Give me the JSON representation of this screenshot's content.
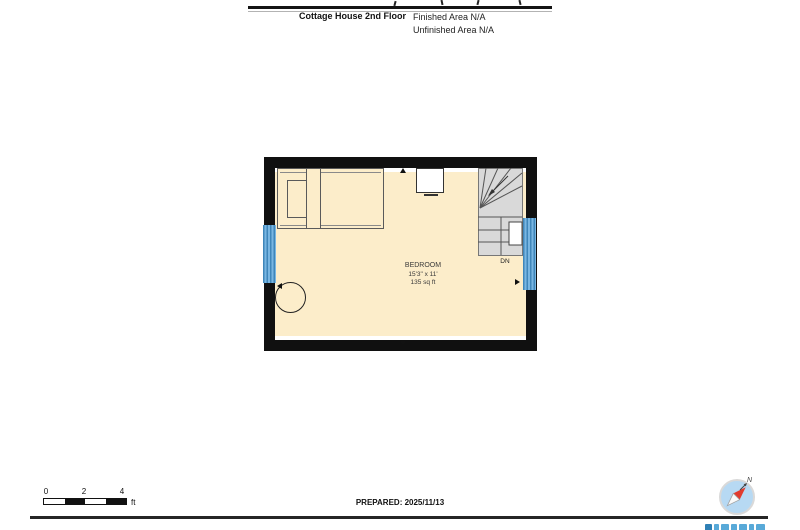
{
  "header": {
    "title": "Cottage House 2nd Floor",
    "finished_area_label": "Finished Area N/A",
    "unfinished_area_label": "Unfinished Area N/A"
  },
  "floor_plan": {
    "room": {
      "name": "BEDROOM",
      "dimensions": "15'3\" x 11'",
      "area": "135 sq ft"
    },
    "stairs": {
      "direction_label": "DN"
    }
  },
  "scale_bar": {
    "ticks": [
      "0",
      "2",
      "4"
    ],
    "unit": "ft"
  },
  "footer": {
    "prepared_label": "PREPARED: 2025/11/13",
    "compass_north_label": "N"
  },
  "colors": {
    "floor_fill": "#fcedca",
    "wall": "#101010",
    "window_blue": "#5b9fd4",
    "stair_fill": "#d9d9d9",
    "compass_face": "#b7d9f3",
    "compass_needle_red": "#e23b2e",
    "logo_blue": "#58a9d8"
  }
}
